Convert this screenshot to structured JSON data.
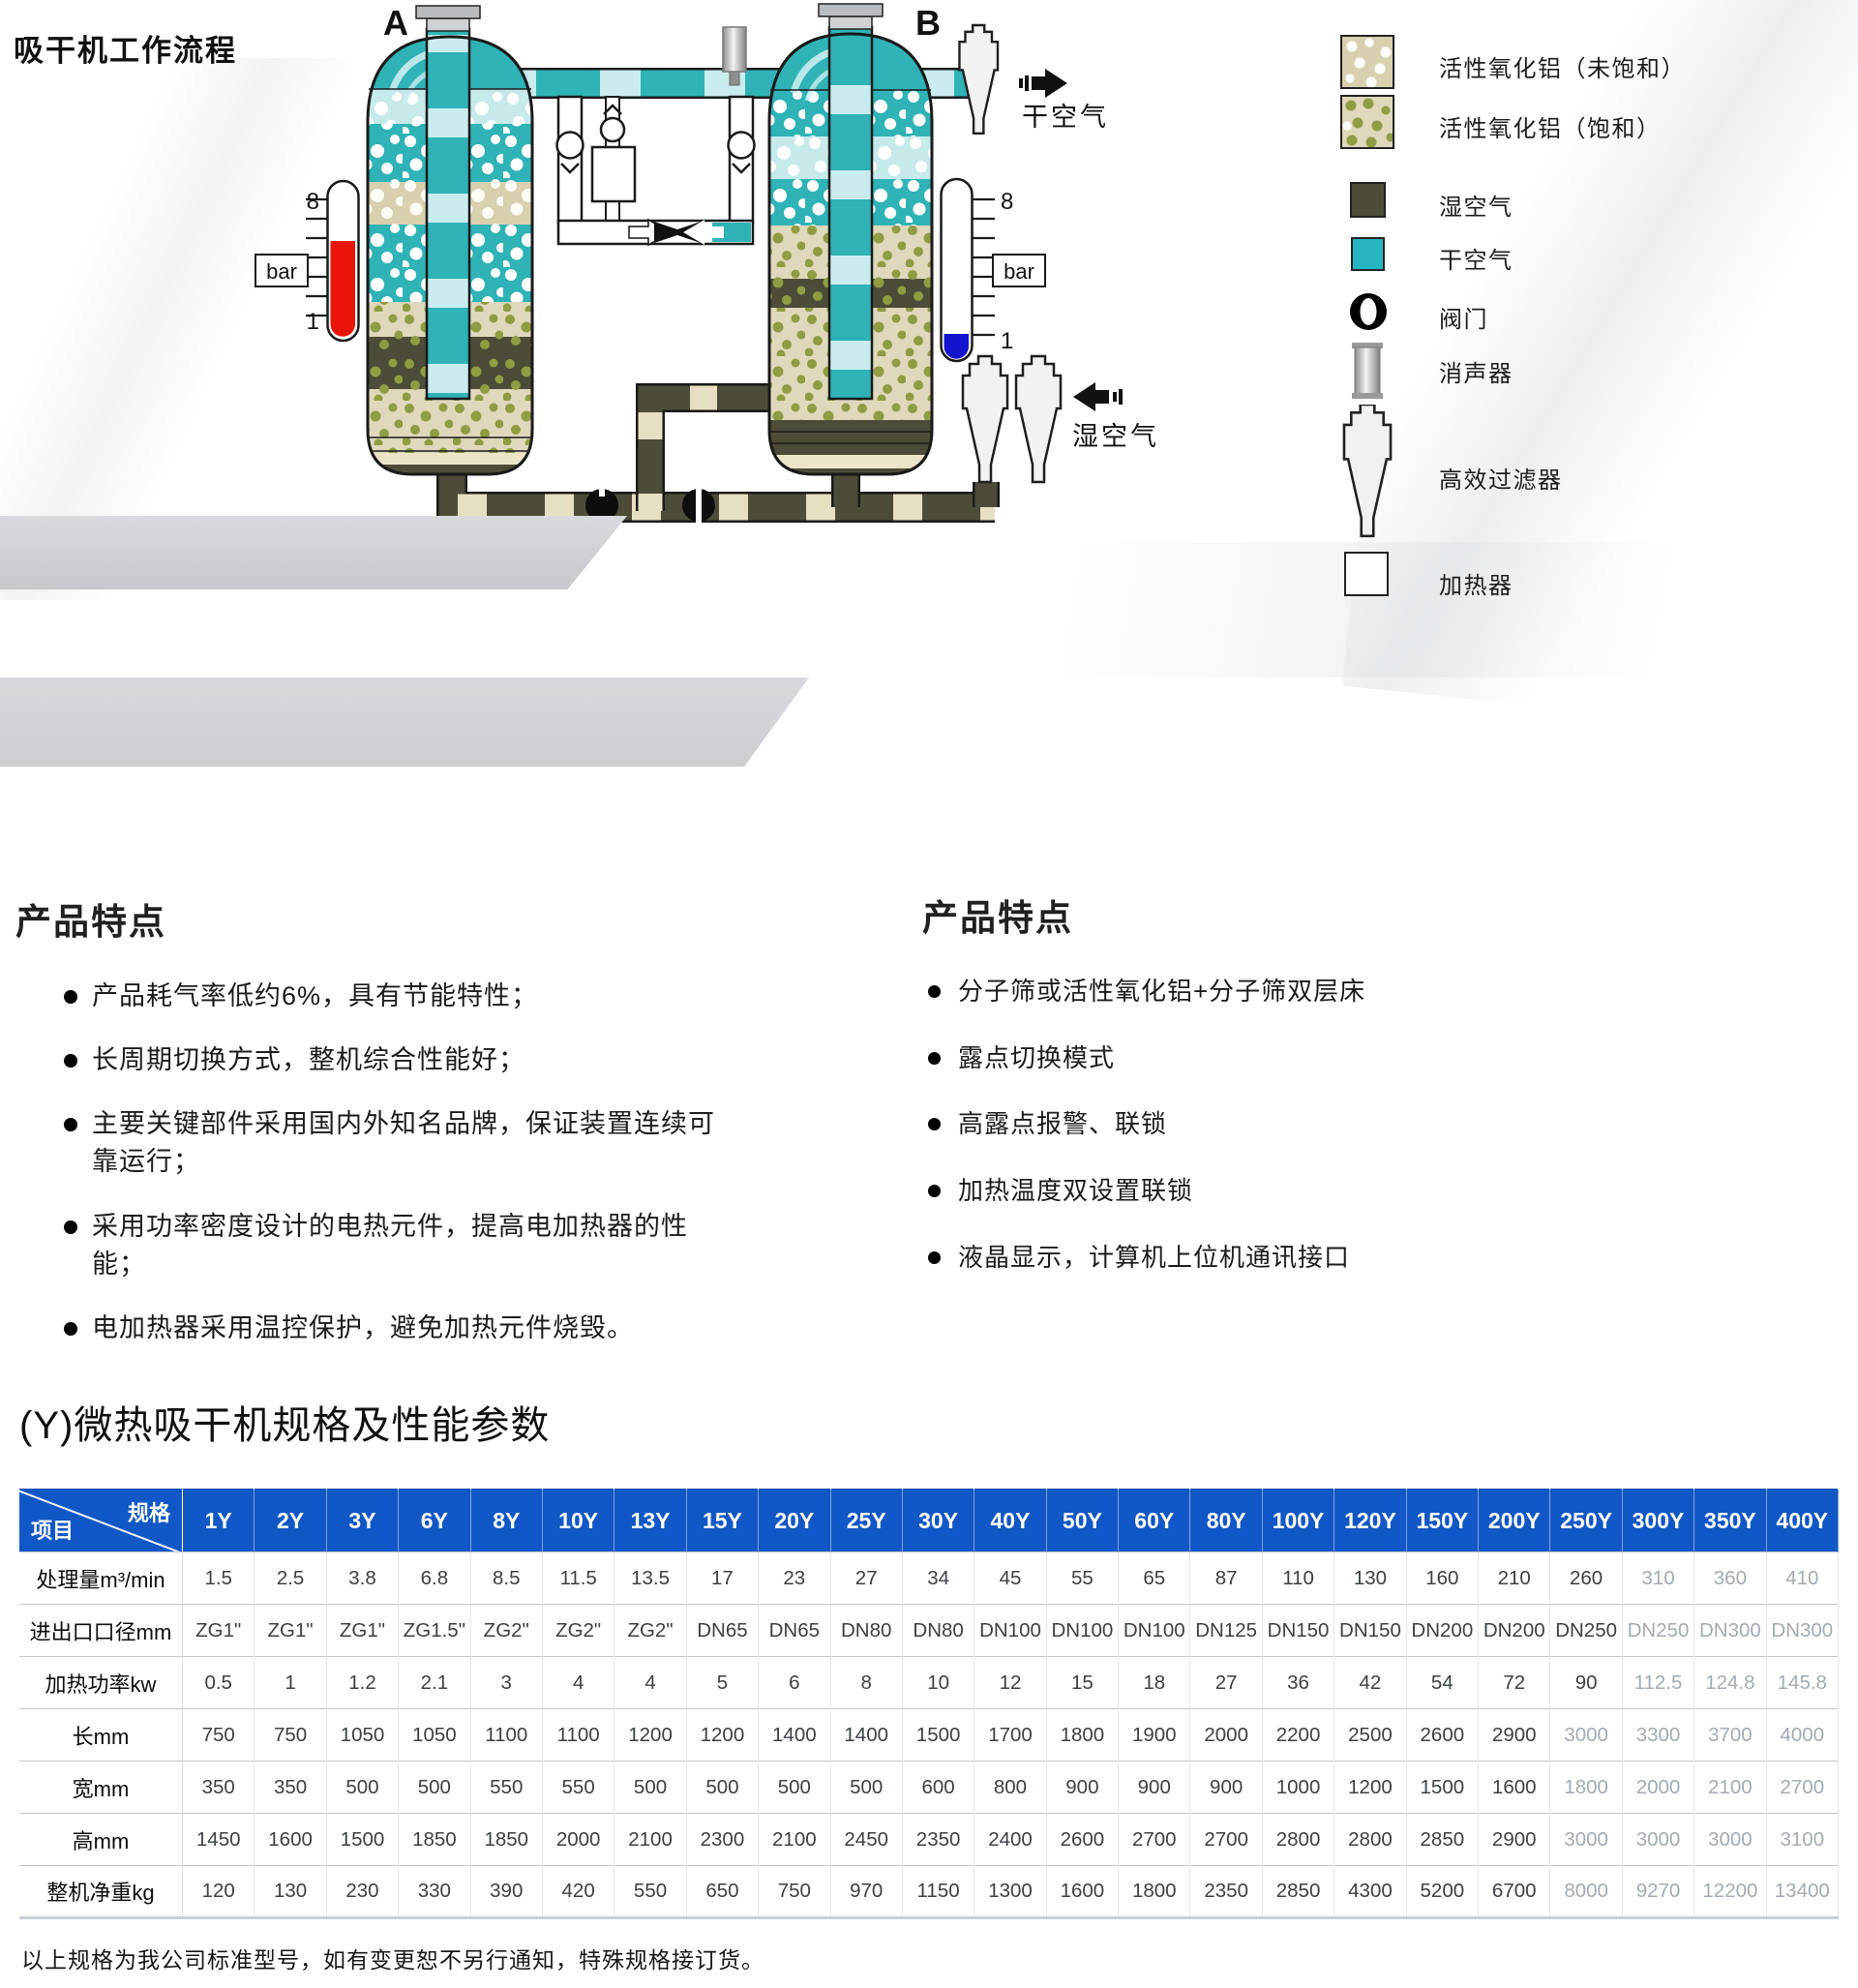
{
  "page": {
    "title": "吸干机工作流程",
    "footer_note": "以上规格为我公司标准型号，如有变更恕不另行通知，特殊规格接订货。"
  },
  "diagram": {
    "tower_a_label": "A",
    "tower_b_label": "B",
    "pressure_unit": "bar",
    "gauge_max": "8",
    "gauge_min": "1",
    "dry_air_label": "干空气",
    "wet_air_label": "湿空气",
    "colors": {
      "dry_air_teal": "#2fb3b6",
      "wet_air_olive": "#4c4c38",
      "pipe_stripe_light": "#c9ecef",
      "pipe_stripe_beige": "#e6e0c2",
      "gauge_red": "#e81508",
      "gauge_blue": "#1414cf",
      "saturated_dot_green": "#8f9c42",
      "alumina_beige": "#d8d0ae"
    },
    "legend": {
      "items": [
        {
          "icon": "alumina-unsaturated-swatch",
          "label": "活性氧化铝（未饱和）"
        },
        {
          "icon": "alumina-saturated-swatch",
          "label": "活性氧化铝（饱和）"
        },
        {
          "icon": "wet-air-swatch",
          "label": "湿空气"
        },
        {
          "icon": "dry-air-swatch",
          "label": "干空气"
        },
        {
          "icon": "valve-icon",
          "label": "阀门"
        },
        {
          "icon": "muffler-icon",
          "label": "消声器"
        },
        {
          "icon": "filter-icon",
          "label": "高效过滤器"
        },
        {
          "icon": "heater-icon",
          "label": "加热器"
        }
      ]
    }
  },
  "features_left": {
    "heading": "产品特点",
    "bullets": [
      "产品耗气率低约6%，具有节能特性；",
      "长周期切换方式，整机综合性能好；",
      "主要关键部件采用国内外知名品牌，保证装置连续可靠运行；",
      "采用功率密度设计的电热元件，提高电加热器的性能；",
      "电加热器采用温控保护，避免加热元件烧毁。"
    ]
  },
  "features_right": {
    "heading": "产品特点",
    "bullets": [
      "分子筛或活性氧化铝+分子筛双层床",
      "露点切换模式",
      "高露点报警、联锁",
      "加热温度双设置联锁",
      "液晶显示，计算机上位机通讯接口"
    ]
  },
  "spec_table": {
    "section_title": "(Y)微热吸干机规格及性能参数",
    "corner_top": "规格",
    "corner_bottom": "项目",
    "columns": [
      "1Y",
      "2Y",
      "3Y",
      "6Y",
      "8Y",
      "10Y",
      "13Y",
      "15Y",
      "20Y",
      "25Y",
      "30Y",
      "40Y",
      "50Y",
      "60Y",
      "80Y",
      "100Y",
      "120Y",
      "150Y",
      "200Y",
      "250Y",
      "300Y",
      "350Y",
      "400Y"
    ],
    "rows": [
      {
        "label": "处理量m³/min",
        "values": [
          "1.5",
          "2.5",
          "3.8",
          "6.8",
          "8.5",
          "11.5",
          "13.5",
          "17",
          "23",
          "27",
          "34",
          "45",
          "55",
          "65",
          "87",
          "110",
          "130",
          "160",
          "210",
          "260",
          "310",
          "360",
          "410"
        ]
      },
      {
        "label": "进出口口径mm",
        "values": [
          "ZG1\"",
          "ZG1\"",
          "ZG1\"",
          "ZG1.5\"",
          "ZG2\"",
          "ZG2\"",
          "ZG2\"",
          "DN65",
          "DN65",
          "DN80",
          "DN80",
          "DN100",
          "DN100",
          "DN100",
          "DN125",
          "DN150",
          "DN150",
          "DN200",
          "DN200",
          "DN250",
          "DN250",
          "DN300",
          "DN300"
        ]
      },
      {
        "label": "加热功率kw",
        "values": [
          "0.5",
          "1",
          "1.2",
          "2.1",
          "3",
          "4",
          "4",
          "5",
          "6",
          "8",
          "10",
          "12",
          "15",
          "18",
          "27",
          "36",
          "42",
          "54",
          "72",
          "90",
          "112.5",
          "124.8",
          "145.8"
        ]
      },
      {
        "label": "长mm",
        "values": [
          "750",
          "750",
          "1050",
          "1050",
          "1100",
          "1100",
          "1200",
          "1200",
          "1400",
          "1400",
          "1500",
          "1700",
          "1800",
          "1900",
          "2000",
          "2200",
          "2500",
          "2600",
          "2900",
          "3000",
          "3300",
          "3700",
          "4000"
        ]
      },
      {
        "label": "宽mm",
        "values": [
          "350",
          "350",
          "500",
          "500",
          "550",
          "550",
          "500",
          "500",
          "500",
          "500",
          "600",
          "800",
          "900",
          "900",
          "900",
          "1000",
          "1200",
          "1500",
          "1600",
          "1800",
          "2000",
          "2100",
          "2700"
        ]
      },
      {
        "label": "高mm",
        "values": [
          "1450",
          "1600",
          "1500",
          "1850",
          "1850",
          "2000",
          "2100",
          "2300",
          "2100",
          "2450",
          "2350",
          "2400",
          "2600",
          "2700",
          "2700",
          "2800",
          "2800",
          "2850",
          "2900",
          "3000",
          "3000",
          "3000",
          "3100"
        ]
      },
      {
        "label": "整机净重kg",
        "values": [
          "120",
          "130",
          "230",
          "330",
          "390",
          "420",
          "550",
          "650",
          "750",
          "970",
          "1150",
          "1300",
          "1600",
          "1800",
          "2350",
          "2850",
          "4300",
          "5200",
          "6700",
          "8000",
          "9270",
          "12200",
          "13400"
        ]
      }
    ]
  }
}
